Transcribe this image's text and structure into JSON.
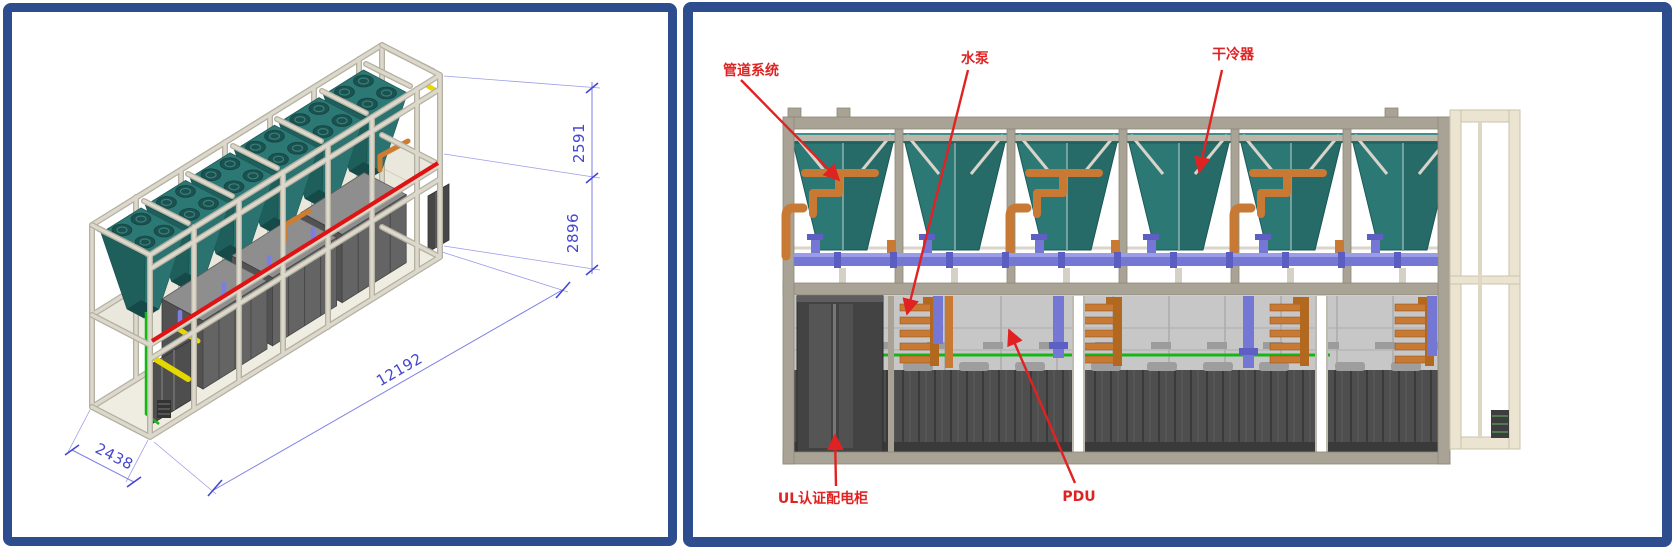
{
  "left_panel": {
    "dimensions": {
      "upper_height": "2591",
      "lower_height": "2896",
      "length": "12192",
      "width": "2438"
    }
  },
  "right_panel": {
    "labels": {
      "piping": "管道系统",
      "pump": "水泵",
      "dry_cooler": "干冷器",
      "ul_cabinet": "UL认证配电柜",
      "pdu": "PDU"
    }
  },
  "colors": {
    "panel_border": "#2e4d8e",
    "annotation_red": "#e02222",
    "dimension_blue": "#4547cf",
    "cooler_teal": "#2c7875",
    "frame_beige": "#dcd8cb",
    "frame_taupe": "#a9a396",
    "pipe_orange": "#c87a34",
    "pipe_purple": "#7577d5",
    "pipe_green": "#14b814",
    "cabinet_gray": "#4e4e4e"
  }
}
